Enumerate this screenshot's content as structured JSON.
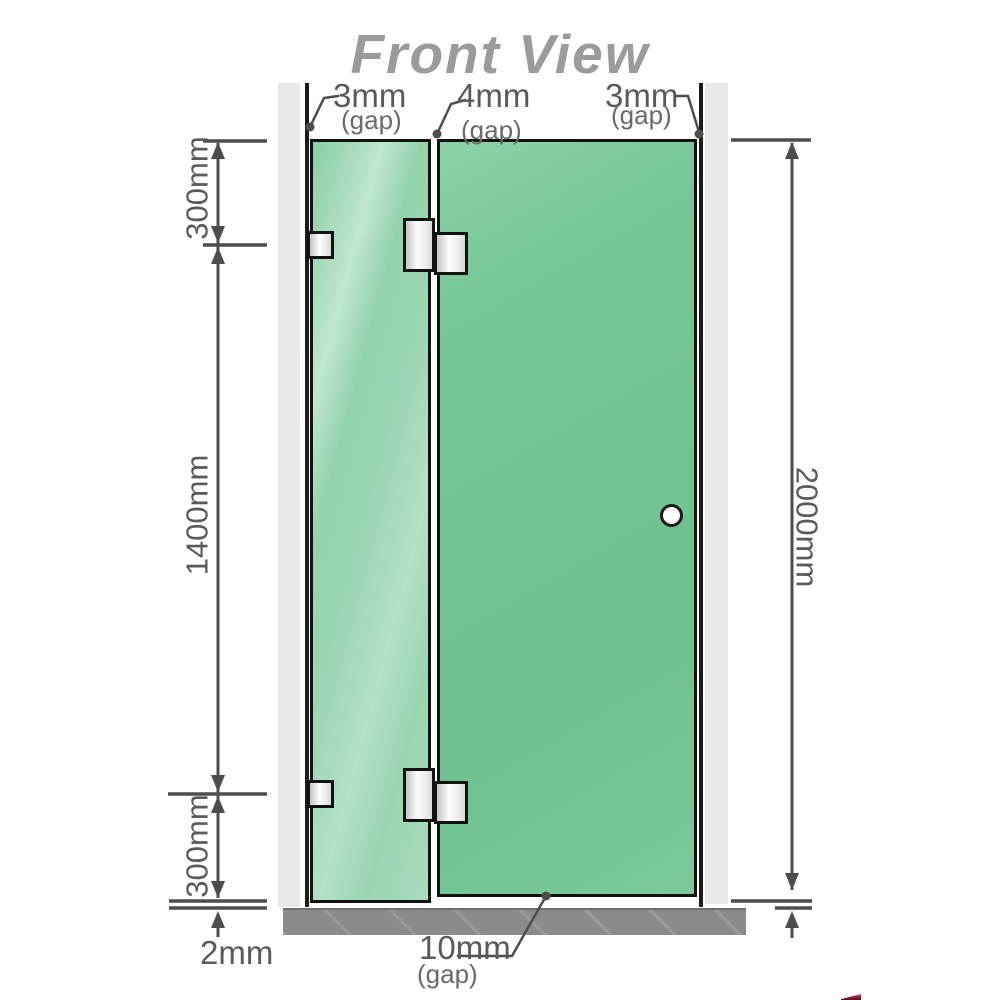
{
  "title": "Front View",
  "dimensions": {
    "top_gaps": [
      {
        "value": "3mm",
        "label": "(gap)"
      },
      {
        "value": "4mm",
        "label": "(gap)"
      },
      {
        "value": "3mm",
        "label": "(gap)"
      }
    ],
    "left": {
      "top_section": "300mm",
      "middle_section": "1400mm",
      "bottom_section": "300mm",
      "floor_gap": "2mm"
    },
    "right": {
      "total_height": "2000mm"
    },
    "bottom_gap": {
      "value": "10mm",
      "label": "(gap)"
    }
  },
  "colors": {
    "glass_fixed_panel": "#9ad5b3",
    "glass_door_panel": "#74c594",
    "wall": "#e9e9e9",
    "floor": "#8b8b8b",
    "dimension_lines": "#4d4d4d",
    "title_text": "#9b9b9b",
    "corner_mark_red": "#7d1426"
  }
}
